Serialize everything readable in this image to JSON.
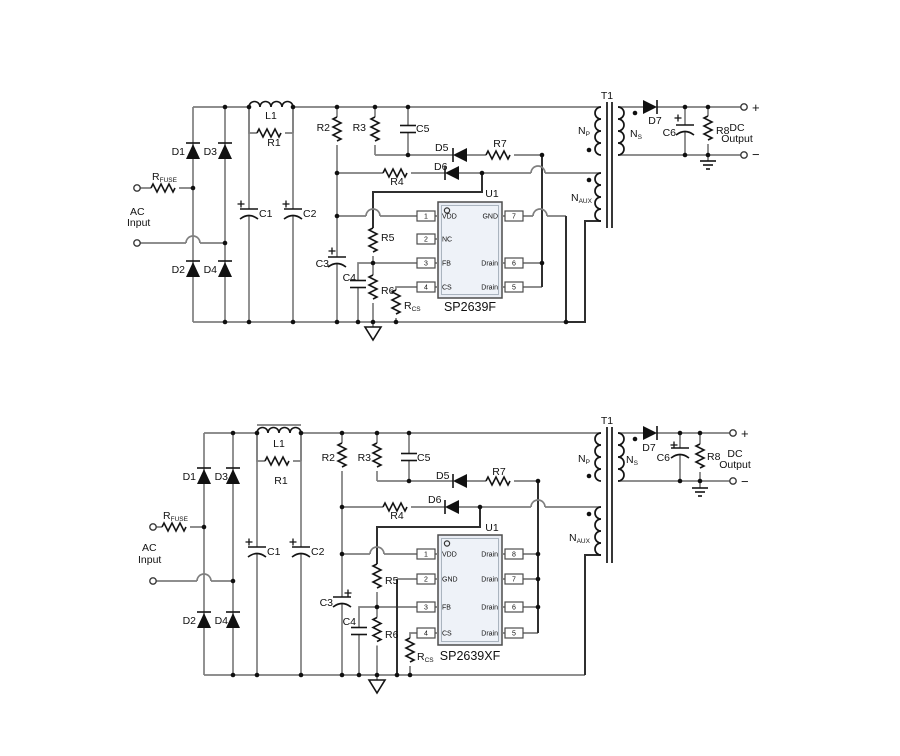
{
  "colors": {
    "background": "#ffffff",
    "wire": "#7f7f7f",
    "dark_wire": "#2f2f2f",
    "component": "#141414",
    "ic_fill": "#e9edf4",
    "text": "#111111"
  },
  "circuits": [
    {
      "name": "SP2639F application circuit",
      "labels": {
        "ac1": "AC",
        "ac2": "Input",
        "rfuse_m": "R",
        "rfuse_s": "FUSE",
        "d1": "D1",
        "d2": "D2",
        "d3": "D3",
        "d4": "D4",
        "c1": "C1",
        "c2": "C2",
        "l1": "L1",
        "r1": "R1",
        "r2": "R2",
        "r3": "R3",
        "c5": "C5",
        "d5": "D5",
        "d6": "D6",
        "r7": "R7",
        "r4": "R4",
        "r5": "R5",
        "r6": "R6",
        "c3": "C3",
        "c4": "C4",
        "rcs_m": "R",
        "rcs_s": "CS",
        "t1": "T1",
        "np_m": "N",
        "np_s": "P",
        "ns_m": "N",
        "ns_s": "S",
        "naux_m": "N",
        "naux_s": "AUX",
        "d7": "D7",
        "c6": "C6",
        "r8": "R8",
        "plus": "+",
        "minus": "−",
        "dc1": "DC",
        "dc2": "Output"
      },
      "ic": {
        "ref": "U1",
        "part": "SP2639F",
        "left_pins": [
          {
            "num": "1",
            "name": "VDD"
          },
          {
            "num": "2",
            "name": "NC"
          },
          {
            "num": "3",
            "name": "FB"
          },
          {
            "num": "4",
            "name": "CS"
          }
        ],
        "right_pins": [
          {
            "num": "7",
            "name": "GND"
          },
          {
            "num": "6",
            "name": "Drain"
          },
          {
            "num": "5",
            "name": "Drain"
          }
        ]
      }
    },
    {
      "name": "SP2639XF application circuit",
      "labels": {
        "ac1": "AC",
        "ac2": "Input",
        "rfuse_m": "R",
        "rfuse_s": "FUSE",
        "d1": "D1",
        "d2": "D2",
        "d3": "D3",
        "d4": "D4",
        "c1": "C1",
        "c2": "C2",
        "l1": "L1",
        "r1": "R1",
        "r2": "R2",
        "r3": "R3",
        "c5": "C5",
        "d5": "D5",
        "d6": "D6",
        "r7": "R7",
        "r4": "R4",
        "r5": "R5",
        "r6": "R6",
        "c3": "C3",
        "c4": "C4",
        "rcs_m": "R",
        "rcs_s": "CS",
        "t1": "T1",
        "np_m": "N",
        "np_s": "P",
        "ns_m": "N",
        "ns_s": "S",
        "naux_m": "N",
        "naux_s": "AUX",
        "d7": "D7",
        "c6": "C6",
        "r8": "R8",
        "plus": "+",
        "minus": "−",
        "dc1": "DC",
        "dc2": "Output"
      },
      "ic": {
        "ref": "U1",
        "part": "SP2639XF",
        "left_pins": [
          {
            "num": "1",
            "name": "VDD"
          },
          {
            "num": "2",
            "name": "GND"
          },
          {
            "num": "3",
            "name": "FB"
          },
          {
            "num": "4",
            "name": "CS"
          }
        ],
        "right_pins": [
          {
            "num": "8",
            "name": "Drain"
          },
          {
            "num": "7",
            "name": "Drain"
          },
          {
            "num": "6",
            "name": "Drain"
          },
          {
            "num": "5",
            "name": "Drain"
          }
        ]
      }
    }
  ]
}
